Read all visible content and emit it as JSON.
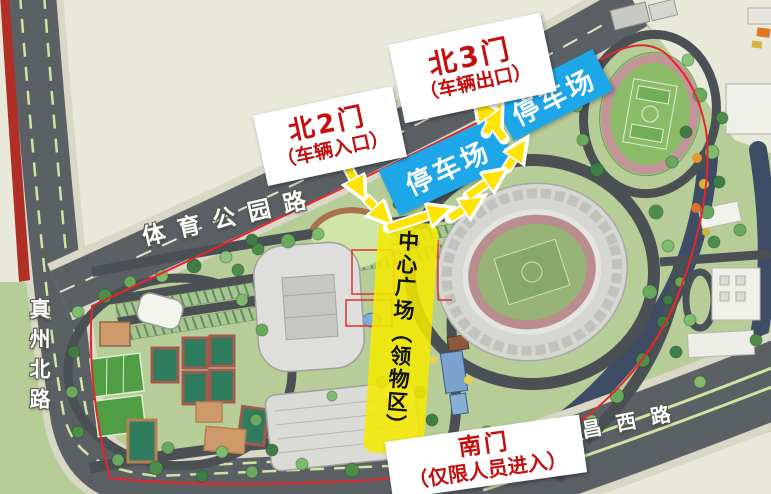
{
  "map": {
    "road_labels": {
      "north_road": "体育公园路",
      "west_road": "真州北路",
      "south_road": "文昌西路"
    },
    "gates": {
      "north2": {
        "name": "北2门",
        "note": "（车辆入口）"
      },
      "north3": {
        "name": "北3门",
        "note": "（车辆出口）"
      },
      "south": {
        "name": "南门",
        "note": "（仅限人员进入）"
      }
    },
    "zones": {
      "parking_upper": "停车场",
      "parking_lower": "停车场",
      "central_plaza": "中心广场（领物区）"
    },
    "colors": {
      "gate_text": "#c40f0f",
      "parking_bg": "#1ea7e8",
      "plaza_bg": "#f6ea00",
      "arrow": "#ffe400",
      "boundary_line": "#e8262a",
      "road_fill": "#5b6065",
      "park_green": "#b7cd97",
      "water": "#3e4c66",
      "outside_bg": "#e9e9da",
      "road_label_text": "#ffffff"
    }
  }
}
